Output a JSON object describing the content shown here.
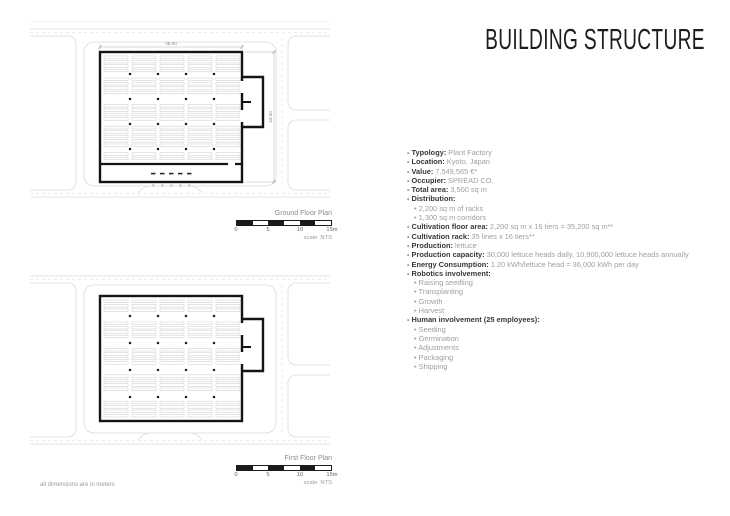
{
  "title": "BUILDING STRUCTURE",
  "footnote": "all dimensions are in meters",
  "plans": {
    "ground": {
      "label": "Ground Floor Plan",
      "dim_width": "48.00",
      "dim_height": "43.00",
      "scale_ticks": [
        "0",
        "5",
        "10",
        "15m"
      ],
      "scale_note": "scale: NTS"
    },
    "first": {
      "label": "First Floor Plan",
      "scale_ticks": [
        "0",
        "5",
        "10",
        "15m"
      ],
      "scale_note": "scale: NTS"
    }
  },
  "specs": [
    {
      "label": "Typology:",
      "value": "Plant Factory",
      "bullets": []
    },
    {
      "label": "Location:",
      "value": "Kyoto, Japan",
      "bullets": []
    },
    {
      "label": "Value:",
      "value": "7,549,565 €*",
      "bullets": []
    },
    {
      "label": "Occupier:",
      "value": "SPREAD CO.",
      "bullets": []
    },
    {
      "label": "Total area:",
      "value": "3,500 sq m",
      "bullets": []
    },
    {
      "label": "Distribution:",
      "value": "",
      "bullets": [
        "2,200 sq m of racks",
        "1,300 sq m corridors"
      ]
    },
    {
      "label": "Cultivation floor area:",
      "value": "2,200 sq m x 16 tiers = 35,200 sq m**",
      "bullets": []
    },
    {
      "label": "Cultivation rack:",
      "value": "35 lines x 16 tiers**",
      "bullets": []
    },
    {
      "label": "Production:",
      "value": "lettuce",
      "bullets": []
    },
    {
      "label": "Production capacity:",
      "value": "30,000 lettuce heads daily, 10,900,000 lettuce heads annually",
      "bullets": []
    },
    {
      "label": "Energy Consumption:",
      "value": "1.20 kWh/lettuce head = 36,000 kWh per day",
      "bullets": []
    },
    {
      "label": "Robotics involvement:",
      "value": "",
      "bullets": [
        "Raising seedling",
        "Transplanting",
        "Growth",
        "Harvest"
      ]
    },
    {
      "label": "Human involvement (25 employees):",
      "value": "",
      "bullets": [
        "Seeding",
        "Germination",
        "Adjustments",
        "Packaging",
        "Shipping"
      ]
    }
  ]
}
